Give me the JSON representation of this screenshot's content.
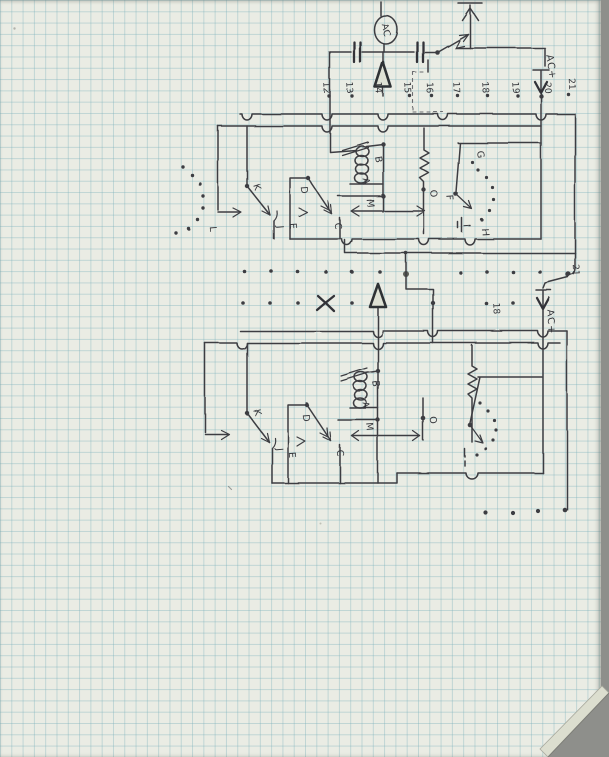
{
  "paper": {
    "background": "#eaece4",
    "grid_color": "#79afba",
    "scanner_edge_color": "#8e8f8b",
    "ink_color": "#3c3d42"
  },
  "top": {
    "ac_circle_label": "AC",
    "ac_plus_label": "AC+",
    "terminal_numbers": [
      "12",
      "13",
      "14",
      "15",
      "16",
      "17",
      "18",
      "19",
      "20",
      "21"
    ]
  },
  "upper_circuit": {
    "labels": {
      "k": "K",
      "l": "L",
      "j": "J",
      "e": "E",
      "d": "D",
      "c": "C",
      "b": "B",
      "a": "A",
      "m": "M",
      "o": "O",
      "f": "F",
      "g": "G",
      "h": "H",
      "i": "I"
    }
  },
  "middle": {
    "junction_21": "21",
    "junction_18": "18",
    "ac_plus_label": "AC+"
  },
  "lower_circuit": {
    "labels": {
      "k": "K",
      "j": "J",
      "e": "E",
      "d": "D",
      "c": "C",
      "b": "B",
      "a": "A",
      "m": "M",
      "o": "O"
    }
  }
}
